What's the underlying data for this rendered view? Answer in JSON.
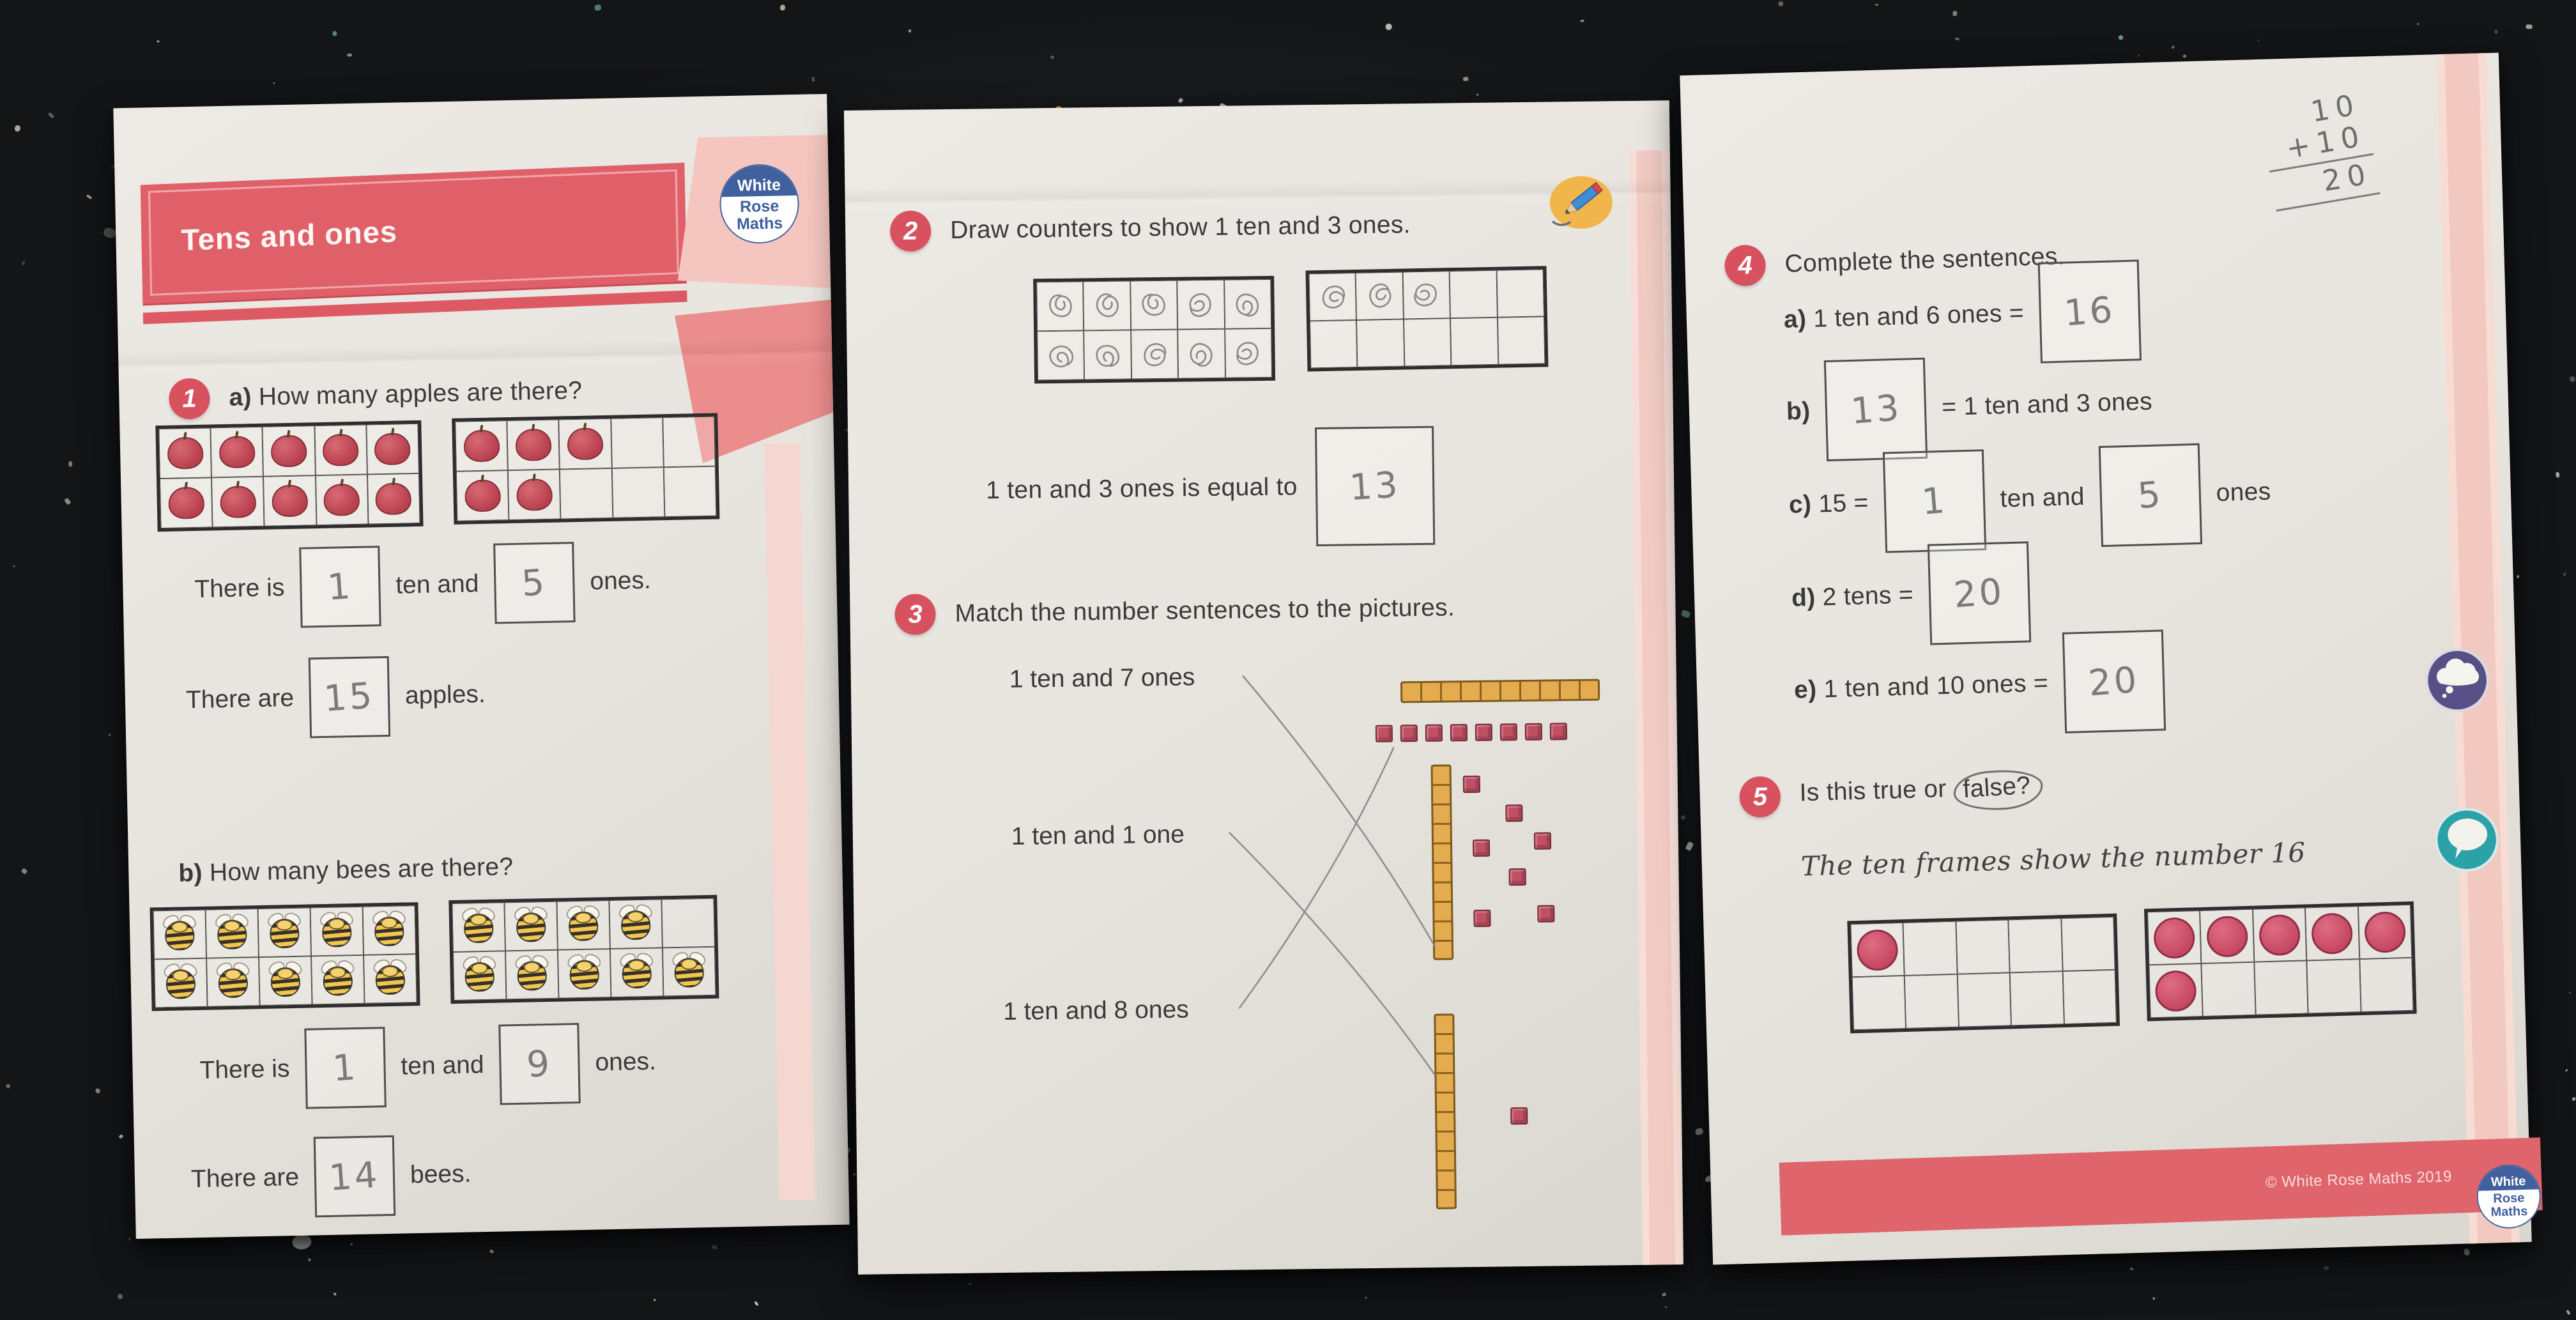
{
  "brand": {
    "logo": [
      "White",
      "Rose",
      "Maths"
    ],
    "logo_blue": "#40609e"
  },
  "left_page": {
    "title": "Tens and ones",
    "q1": {
      "number": "1",
      "a_letter": "a)",
      "a_text": "How many apples are there?",
      "s1": {
        "t1": "There is",
        "ans1": "1",
        "t2": "ten and",
        "ans2": "5",
        "t3": "ones."
      },
      "s2": {
        "t1": "There are",
        "ans": "15",
        "t2": "apples."
      },
      "b_letter": "b)",
      "b_text": "How many bees are there?",
      "s3": {
        "t1": "There is",
        "ans1": "1",
        "t2": "ten and",
        "ans2": "9",
        "t3": "ones."
      },
      "s4": {
        "t1": "There are",
        "ans": "14",
        "t2": "bees."
      }
    }
  },
  "middle_page": {
    "q2": {
      "number": "2",
      "question": "Draw counters to show 1 ten and 3 ones.",
      "equal_text": "1 ten and 3 ones is equal to",
      "answer": "13"
    },
    "q3": {
      "number": "3",
      "question": "Match the number sentences to the pictures.",
      "sentences": [
        "1 ten and 7 ones",
        "1 ten and 1 one",
        "1 ten and 8 ones"
      ],
      "pictures": [
        {
          "tens": 1,
          "ones": 8,
          "layout": "horizontal-rod-with-cube-row"
        },
        {
          "tens": 1,
          "ones": 7,
          "layout": "vertical-rod-with-scattered-cubes"
        },
        {
          "tens": 1,
          "ones": 1,
          "layout": "vertical-rod-with-single-cube"
        }
      ],
      "matches": [
        {
          "from": 0,
          "to": 1
        },
        {
          "from": 1,
          "to": 2
        },
        {
          "from": 2,
          "to": 0
        }
      ]
    }
  },
  "right_page": {
    "scratch": {
      "top": "10",
      "plus_line": "+10",
      "sum": "20"
    },
    "q4": {
      "number": "4",
      "question": "Complete the sentences.",
      "a": {
        "letter": "a)",
        "text": "1 ten and 6 ones =",
        "answer": "16"
      },
      "b": {
        "letter": "b)",
        "text": "= 1 ten and 3 ones",
        "answer": "13"
      },
      "c": {
        "letter": "c)",
        "text": "15 =",
        "ans1": "1",
        "mid": "ten and",
        "ans2": "5",
        "suffix": "ones"
      },
      "d": {
        "letter": "d)",
        "text": "2 tens =",
        "answer": "20"
      },
      "e": {
        "letter": "e)",
        "text": "1 ten and 10 ones =",
        "answer": "20"
      }
    },
    "q5": {
      "number": "5",
      "prefix": "Is this true or",
      "circled": "false?",
      "statement": "The ten frames show the number 16"
    },
    "footer": "© White Rose Maths 2019"
  },
  "tenframes": {
    "q1a1": {
      "item": "apple",
      "cells": "1111111111"
    },
    "q1a2": {
      "item": "apple",
      "cells": "1110011000"
    },
    "q1b1": {
      "item": "bee",
      "cells": "1111111111"
    },
    "q1b2": {
      "item": "bee",
      "cells": "1111011111"
    },
    "q2a": {
      "item": "scribble",
      "cells": "1111111111"
    },
    "q2b": {
      "item": "scribble",
      "cells": "1110000000"
    },
    "q5a": {
      "item": "counter",
      "cells": "1000000000"
    },
    "q5b": {
      "item": "counter",
      "cells": "1111110000"
    }
  },
  "colors": {
    "banner_red": "#e0606a",
    "ribbon_pink": "#f4c6bf",
    "salmon": "#eb8d8c",
    "strip_pink": "#f1cbc4",
    "question_circle_red": "#d8515f",
    "apple_red": "#c8505b",
    "bee_yellow": "#f1c64e",
    "counter_red": "#cf4f63",
    "rod_yellow": "#e4ab4f",
    "cube_red": "#c04f62",
    "pencil_gray": "#8a8a8a",
    "sticker_purple": "#575086",
    "sticker_teal": "#2ba2a8",
    "footer_text": "#f6dfdd"
  }
}
